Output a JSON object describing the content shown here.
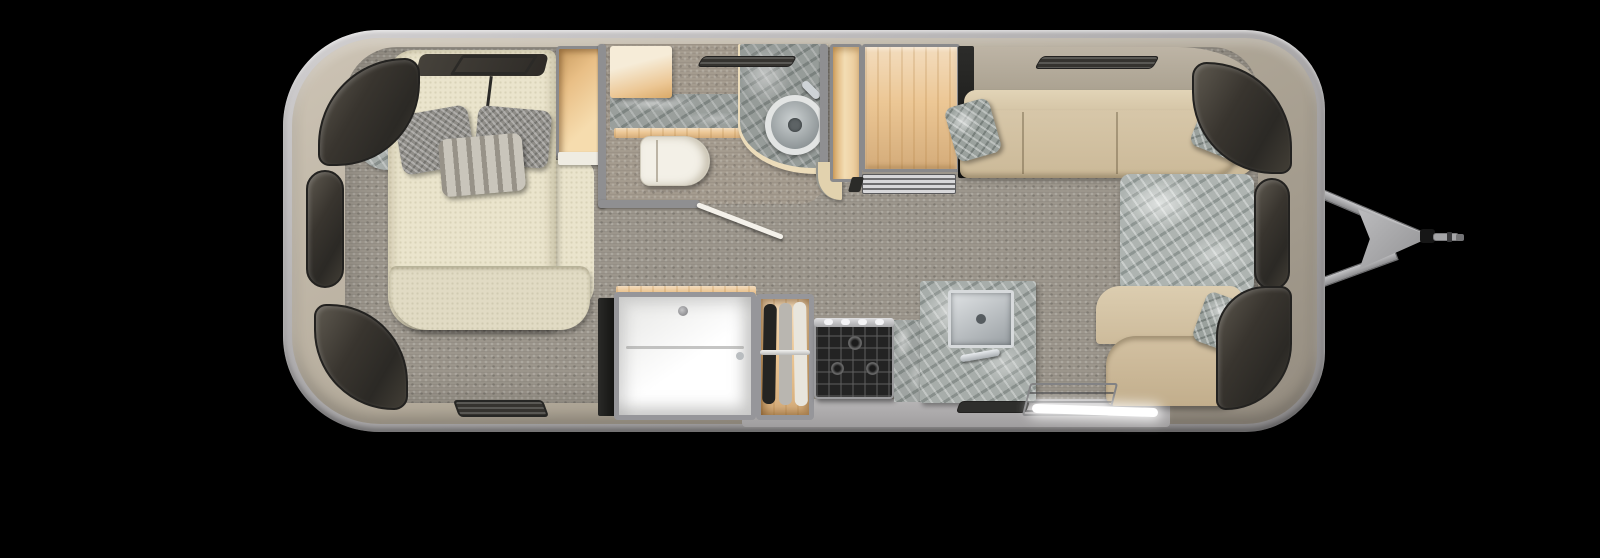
{
  "meta": {
    "title": "Travel trailer floor plan — top-down rendering",
    "canvas": {
      "width": 1600,
      "height": 558
    },
    "background": "#000000"
  },
  "palette": {
    "shell_rim": "#b7b5b6",
    "shell_body": "#b3aa9a",
    "floor": "#9c968c",
    "wood": "#ecc795",
    "marble": "#a7adaa",
    "upholstery": "#d3c3a5",
    "bedding": "#eae4cc",
    "window_glass": "#39352f",
    "stove": "#232323",
    "shower": "#f7f7f5",
    "led": "#ffffff",
    "hitch": "#a6a6a8"
  },
  "regions": {
    "bedroom": {
      "label": "Rear bedroom",
      "items": {
        "bed": "Bed with grey pillows",
        "wardrobe": "Bedside wardrobe cabinet",
        "corner_shelf": "Corner shelf",
        "roof_vent": "Roof vent frame",
        "window_band": "Window above headboard"
      }
    },
    "bathroom": {
      "label": "Bathroom",
      "items": {
        "cabinet": "Storage cabinet",
        "counter": "Vanity counter",
        "toilet": "Toilet",
        "sink": "Round vessel sink",
        "door": "Bathroom door (open)",
        "vanity": "Curved sink vanity"
      }
    },
    "midship": {
      "label": "Midship storage",
      "items": {
        "pantry": "Pantry cabinet",
        "refrigerator": "Refrigerator",
        "appliance_grill": "Appliance vent grill",
        "divider": "Divider panel",
        "shower": "Shower stall",
        "closet": "Hanging wardrobe closet"
      }
    },
    "kitchen": {
      "label": "Galley kitchen",
      "items": {
        "cooktop": "Gas cooktop with burners",
        "counter": "Stone countertop",
        "sink": "Square stainless sink",
        "toe_vent": "Toe-kick vent",
        "entry_step": "Entry step",
        "led_strip": "Entry LED light strip"
      }
    },
    "lounge": {
      "label": "Front lounge / dinette",
      "items": {
        "sofa": "Curbside sofa",
        "table": "Stone-top table",
        "bench": "Front bench seat",
        "pillows": "Accent pillows"
      }
    },
    "exterior": {
      "label": "Exterior",
      "items": {
        "shell": "Rounded trailer shell",
        "windows": "Wrap-around tinted windows",
        "vent_top": "Sidewall vent (front)",
        "vent_bottom": "Sidewall vent (rear)",
        "hitch": "A-frame tow hitch with coupler"
      }
    }
  }
}
